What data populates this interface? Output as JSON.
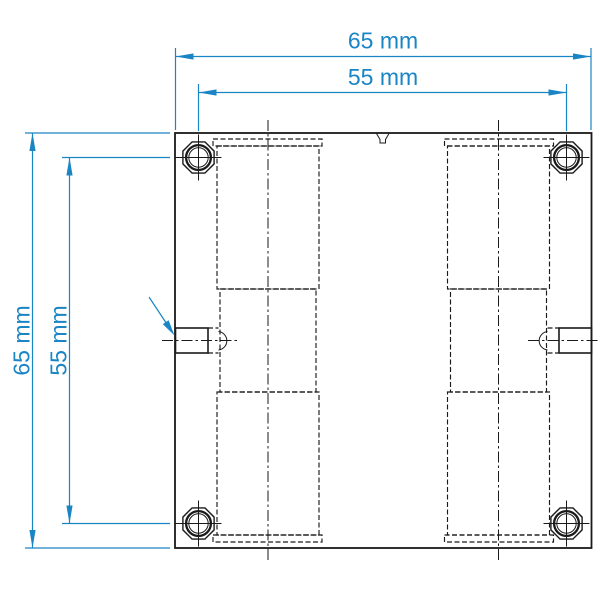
{
  "colors": {
    "dimension": "#1a85c4",
    "line": "#1a1a1a",
    "background": "#ffffff"
  },
  "dimensions": {
    "top_outer": {
      "label": "65 mm"
    },
    "top_inner": {
      "label": "55 mm"
    },
    "left_outer": {
      "label": "65 mm"
    },
    "left_inner": {
      "label": "55 mm"
    }
  }
}
